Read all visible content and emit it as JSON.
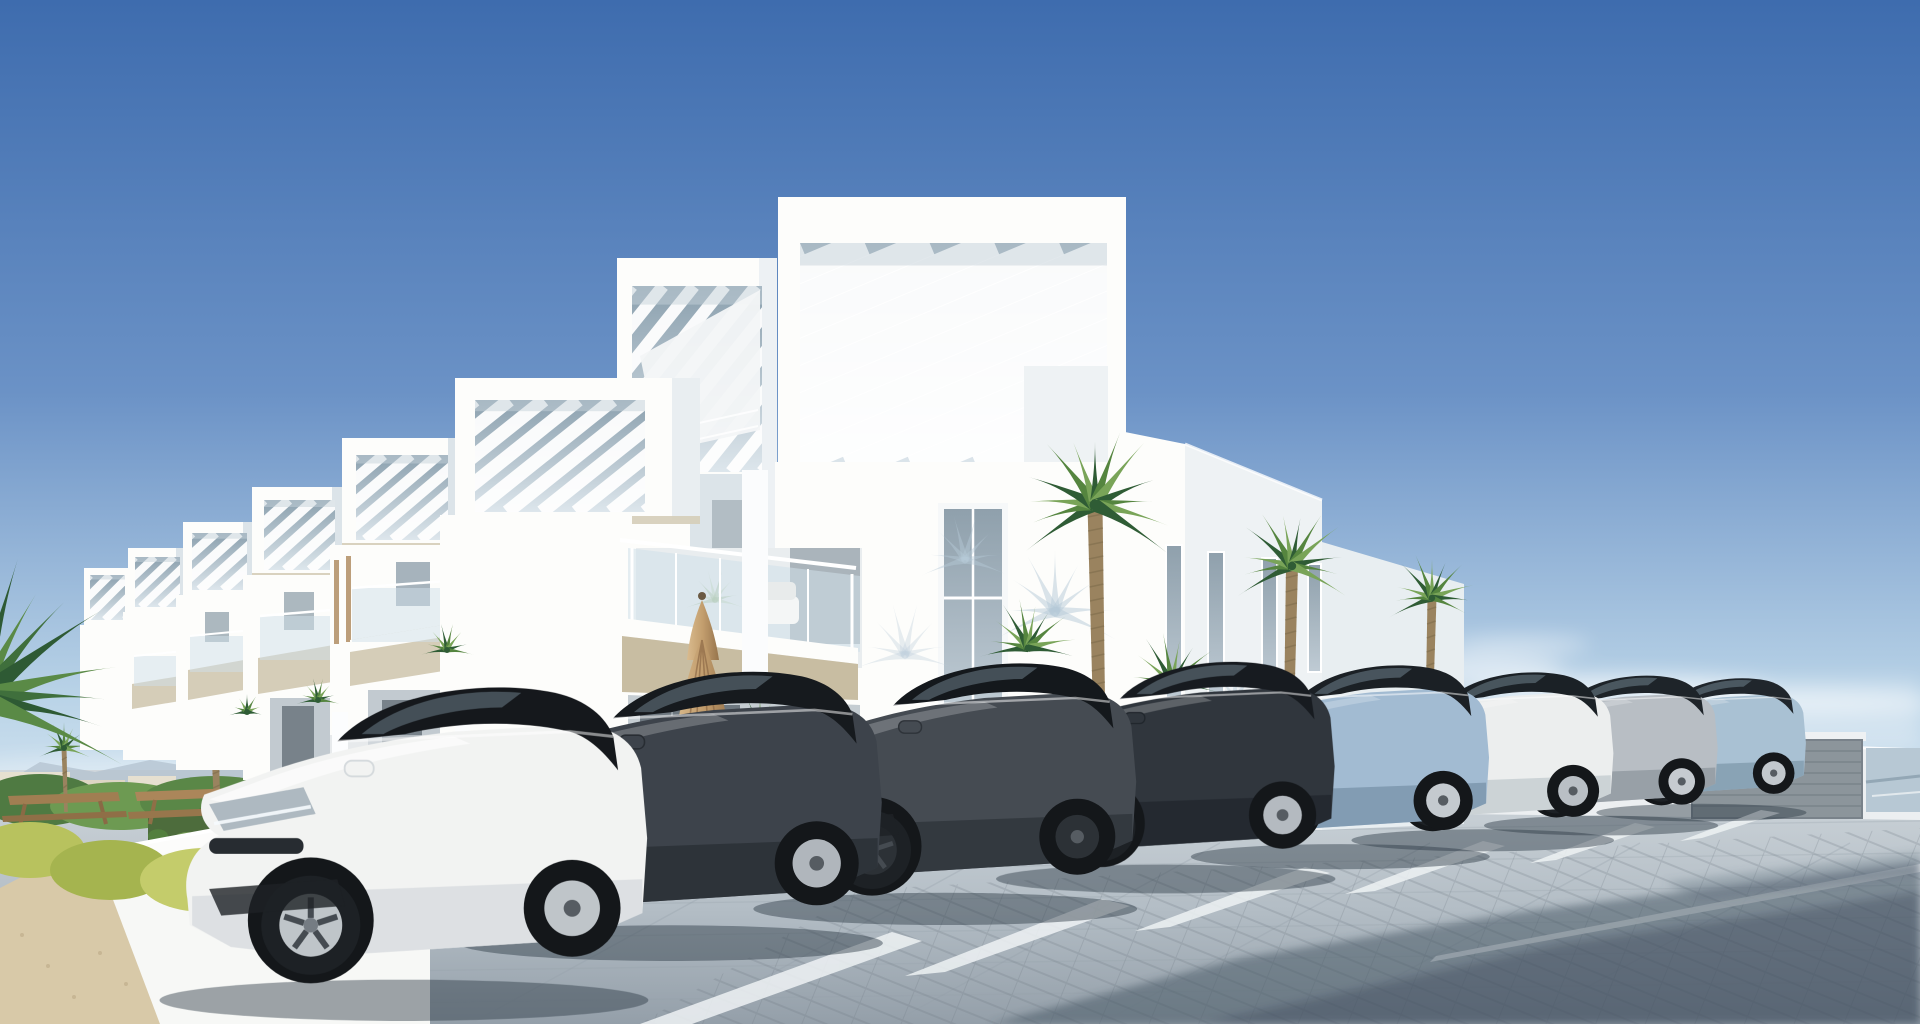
{
  "scene": {
    "subject": "sunny 3D render of a modern white apartment complex with rooftop pergolas, fan palms and a block-paved car park full of parked cars",
    "elements": [
      "clear blue sky",
      "row of receding white townhouses with pergola roof boxes",
      "three-storey white apartment building",
      "glass balustrade balcony with white chair",
      "closed beige patio umbrella",
      "fan palm trees",
      "green hedge with white trellis",
      "white garden wall",
      "wooden picnic tables",
      "yellow-green shrubs",
      "sand path",
      "block-paved parking lot with white bay lines",
      "eight parked cars",
      "gray sectional garage door in boundary wall",
      "soft clouds near the horizon",
      "large shadow across the foreground paving"
    ],
    "car_count": 8,
    "lighting": "bright midday sun from the left"
  },
  "colors": {
    "sky_top": "#3e6cae",
    "sky_mid": "#6b92c6",
    "sky_low": "#b9d3e7",
    "sky_horizon": "#e2eef6",
    "white_sunlit": "#fdfdfb",
    "white_soft": "#eef2f4",
    "white_shade": "#dce4e9",
    "beige_slab": "#d5cdb8",
    "beige_deep": "#c8bda2",
    "opening_dark": "#8ba0ae",
    "opening_light": "#dde6ec",
    "glass_blue": "#cfe0ea",
    "window_gray": "#97a6b0",
    "green_dark": "#2f5c35",
    "green_mid": "#55853f",
    "green_light": "#79a458",
    "green_yellow": "#b5c25e",
    "hedge": "#4d6c3c",
    "lattice": "#e9ede8",
    "grass_light": "#c2cf6e",
    "trunk": "#9a835f",
    "wood": "#9b7a52",
    "wood_light": "#b5946c",
    "wall_white": "#f7f8f6",
    "sand": "#d8c9a8",
    "pavement_light": "#d0d7dc",
    "pavement_mid": "#b3bdc5",
    "pavement_dark": "#949fa9",
    "shadow_blue": "#b6c9d7",
    "shadow_deep": "#42525f",
    "garage": "#8c959b",
    "sea": "#b7c8d4",
    "mountain": "#b3c2cf",
    "cloud": "#ffffff",
    "umbrella_light": "#d9bb8e",
    "umbrella_mid": "#c29d6d",
    "umbrella_dark": "#96744c",
    "distant_bld": "#e6e0d0"
  },
  "cars": [
    {
      "name": "car-pale-blue-mercedes",
      "body": "#a9c1d3",
      "shade": "#7f98ab",
      "glass": "#20262c",
      "rim": "#c2c8cd",
      "head": "#d8e2e8",
      "grille": "star",
      "x": 1600,
      "bottom": 822,
      "scale": 0.52
    },
    {
      "name": "car-silver-mercedes",
      "body": "#b8bec4",
      "shade": "#8e969d",
      "glass": "#1e2429",
      "rim": "#c6cbd0",
      "head": "#dde6eb",
      "grille": "star",
      "x": 1488,
      "bottom": 836,
      "scale": 0.58
    },
    {
      "name": "car-white-compact-sedan",
      "body": "#eceeee",
      "shade": "#c2c9cd",
      "glass": "#1b2126",
      "rim": "#b9bfc5",
      "head": "#cfd9df",
      "grille": "hex",
      "x": 1356,
      "bottom": 852,
      "scale": 0.65
    },
    {
      "name": "car-light-blue-jaguar",
      "body": "#a2bbd2",
      "shade": "#7792a8",
      "glass": "#1b2025",
      "rim": "#c4cacf",
      "head": "#d5dfe6",
      "grille": "mesh",
      "x": 1196,
      "bottom": 870,
      "scale": 0.74
    },
    {
      "name": "car-dark-audi-sedan",
      "body": "#30363d",
      "shade": "#20262c",
      "glass": "#171b20",
      "rim": "#b4bac0",
      "head": "#c3ced6",
      "grille": "slats",
      "x": 1002,
      "bottom": 894,
      "scale": 0.84
    },
    {
      "name": "car-graphite-audi-sportback",
      "body": "#454b52",
      "shade": "#2e3339",
      "glass": "#14181c",
      "rim": "#2c3136",
      "head": "#cdd8e0",
      "grille": "hex",
      "x": 760,
      "bottom": 926,
      "scale": 0.95
    },
    {
      "name": "car-dark-gray-peugeot",
      "body": "#3d434b",
      "shade": "#282d33",
      "glass": "#161a1e",
      "rim": "#b0b6bc",
      "head": "#c9d4dc",
      "grille": "bars",
      "x": 466,
      "bottom": 962,
      "scale": 1.05
    },
    {
      "name": "car-white-electric-sedan",
      "body": "#f2f3f2",
      "shade": "#d5dadd",
      "glass": "#15181c",
      "rim": "#bfc5c9",
      "head": "#aeb9c1",
      "grille": "slit",
      "x": 168,
      "bottom": 1022,
      "scale": 1.21
    }
  ],
  "palms": [
    {
      "name": "corner-palm-fronds",
      "x": -20,
      "y": 700,
      "r": 150,
      "n": 8,
      "a0": -75,
      "a1": 15,
      "cols": [
        "#2e5a34",
        "#5a8a46",
        "#3f6f3c"
      ]
    },
    {
      "name": "left-palm-tree",
      "x": 214,
      "y": 720,
      "r": 42,
      "n": 11,
      "a0": -200,
      "a1": 20,
      "t": {
        "to": 828,
        "w": 8,
        "lean": 4
      }
    },
    {
      "name": "left-small-palm",
      "x": 64,
      "y": 748,
      "r": 26,
      "n": 9,
      "a0": -190,
      "a1": 10,
      "t": {
        "to": 812,
        "w": 5,
        "lean": 2
      }
    },
    {
      "name": "facade-palm-shadow-1",
      "x": 1055,
      "y": 612,
      "r": 62,
      "n": 9,
      "a0": -195,
      "a1": 15,
      "cols": [
        "#b6c9d7"
      ],
      "op": 0.5
    },
    {
      "name": "facade-palm-shadow-2",
      "x": 965,
      "y": 560,
      "r": 46,
      "n": 8,
      "a0": -190,
      "a1": 10,
      "cols": [
        "#b6c9d7"
      ],
      "op": 0.45
    },
    {
      "name": "facade-palm-shadow-3",
      "x": 905,
      "y": 655,
      "r": 52,
      "n": 8,
      "a0": -185,
      "a1": 5,
      "cols": [
        "#c2d3df"
      ],
      "op": 0.4
    },
    {
      "name": "facade-palm-shadow-4",
      "x": 1235,
      "y": 700,
      "r": 40,
      "n": 7,
      "a0": -190,
      "a1": 10,
      "cols": [
        "#b6c9d7"
      ],
      "op": 0.45
    },
    {
      "name": "tall-fan-palm",
      "x": 1095,
      "y": 505,
      "r": 78,
      "n": 13,
      "a0": -205,
      "a1": 25,
      "t": {
        "to": 812,
        "w": 15,
        "lean": 6
      }
    },
    {
      "name": "second-fan-palm",
      "x": 1292,
      "y": 566,
      "r": 60,
      "n": 12,
      "a0": -200,
      "a1": 20,
      "t": {
        "to": 818,
        "w": 12,
        "lean": -5
      }
    },
    {
      "name": "corner-fan-palm",
      "x": 1432,
      "y": 598,
      "r": 46,
      "n": 11,
      "a0": -195,
      "a1": 15,
      "t": {
        "to": 762,
        "w": 9,
        "lean": -4
      }
    },
    {
      "name": "palmetto-bush-1",
      "x": 1028,
      "y": 648,
      "r": 50,
      "n": 10,
      "a0": -180,
      "a1": 0
    },
    {
      "name": "palmetto-bush-2",
      "x": 1172,
      "y": 684,
      "r": 52,
      "n": 10,
      "a0": -180,
      "a1": 0
    },
    {
      "name": "palmetto-bush-3",
      "x": 760,
      "y": 730,
      "r": 34,
      "n": 9,
      "a0": -180,
      "a1": 0
    },
    {
      "name": "garden-palm-sprig-1",
      "x": 447,
      "y": 650,
      "r": 27,
      "n": 8,
      "a0": -180,
      "a1": 0
    },
    {
      "name": "garden-palm-sprig-2",
      "x": 318,
      "y": 700,
      "r": 22,
      "n": 8,
      "a0": -180,
      "a1": 0
    },
    {
      "name": "garden-palm-sprig-3",
      "x": 247,
      "y": 712,
      "r": 18,
      "n": 7,
      "a0": -180,
      "a1": 0
    },
    {
      "name": "balcony-glass-palm-reflection",
      "x": 715,
      "y": 600,
      "r": 30,
      "n": 8,
      "a0": -185,
      "a1": 5,
      "cols": [
        "#9db98e",
        "#b9d0ab"
      ],
      "op": 0.55
    }
  ],
  "pergolas": [
    {
      "name": "main-roof-pergola",
      "x": 800,
      "y": 243,
      "w": 307,
      "h": 225,
      "slope": 0.42,
      "n": 13
    },
    {
      "name": "tower-pergola",
      "x": 632,
      "y": 286,
      "w": 130,
      "h": 186,
      "slope": 1.25,
      "n": 9
    },
    {
      "name": "townhouse1-pergola",
      "x": 475,
      "y": 400,
      "w": 170,
      "h": 112,
      "slope": 0.8,
      "n": 9
    },
    {
      "name": "townhouse2-pergola",
      "x": 356,
      "y": 455,
      "w": 92,
      "h": 85,
      "slope": 0.85,
      "n": 7
    },
    {
      "name": "townhouse3-pergola",
      "x": 264,
      "y": 500,
      "w": 71,
      "h": 70,
      "slope": 0.9,
      "n": 6
    },
    {
      "name": "townhouse4-pergola",
      "x": 192,
      "y": 533,
      "w": 55,
      "h": 57,
      "slope": 0.9,
      "n": 5
    },
    {
      "name": "townhouse5-pergola",
      "x": 135,
      "y": 557,
      "w": 45,
      "h": 50,
      "slope": 0.95,
      "n": 5
    },
    {
      "name": "townhouse6-pergola",
      "x": 90,
      "y": 575,
      "w": 35,
      "h": 45,
      "slope": 1.0,
      "n": 4
    }
  ]
}
